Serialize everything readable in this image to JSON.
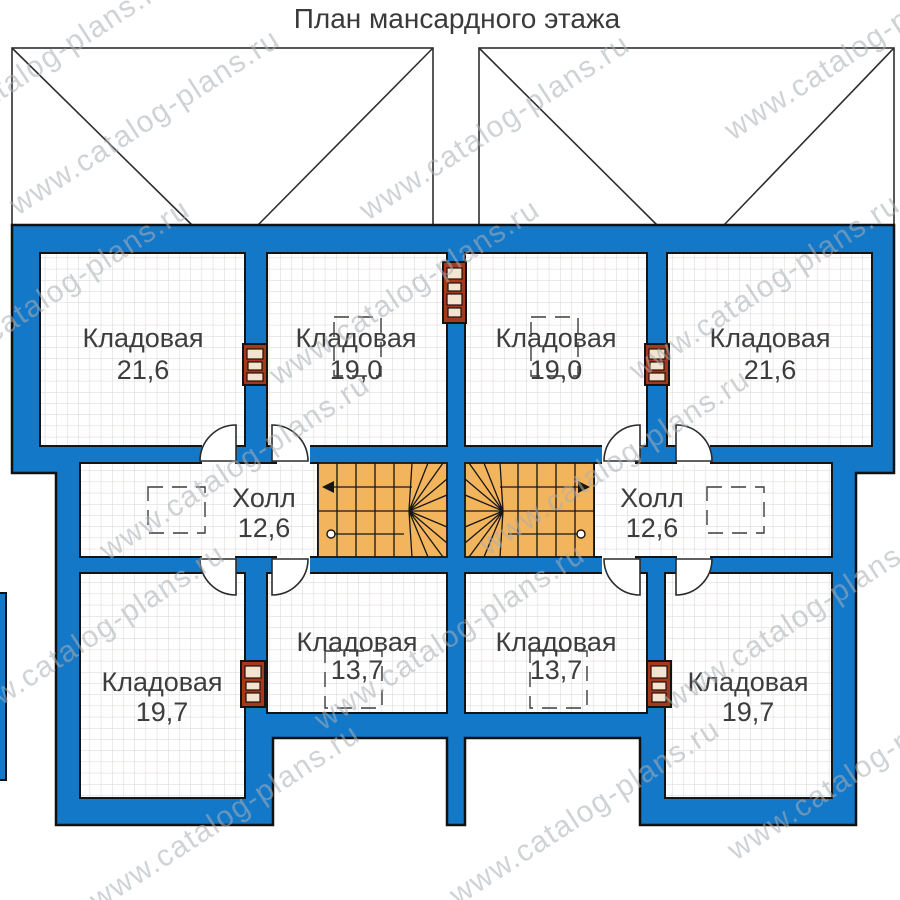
{
  "page": {
    "title": "План мансардного этажа"
  },
  "watermark": {
    "text": "www.catalog-plans.ru"
  },
  "floor_plan": {
    "colors": {
      "wall_fill": "#1478c8",
      "stair_fill": "#f2b45c",
      "chimney_fill": "#a6391c",
      "outline": "#1a1a1a",
      "grid_line": "#d9d5d0"
    },
    "rooms": [
      {
        "id": "storage-top-left",
        "name": "Кладовая",
        "area": "21,6"
      },
      {
        "id": "storage-top-center-left",
        "name": "Кладовая",
        "area": "19,0"
      },
      {
        "id": "storage-top-center-right",
        "name": "Кладовая",
        "area": "19,0"
      },
      {
        "id": "storage-top-right",
        "name": "Кладовая",
        "area": "21,6"
      },
      {
        "id": "hall-left",
        "name": "Холл",
        "area": "12,6"
      },
      {
        "id": "hall-right",
        "name": "Холл",
        "area": "12,6"
      },
      {
        "id": "storage-bottom-left",
        "name": "Кладовая",
        "area": "19,7"
      },
      {
        "id": "storage-bottom-center-left",
        "name": "Кладовая",
        "area": "13,7"
      },
      {
        "id": "storage-bottom-center-right",
        "name": "Кладовая",
        "area": "13,7"
      },
      {
        "id": "storage-bottom-right",
        "name": "Кладовая",
        "area": "19,7"
      }
    ]
  }
}
